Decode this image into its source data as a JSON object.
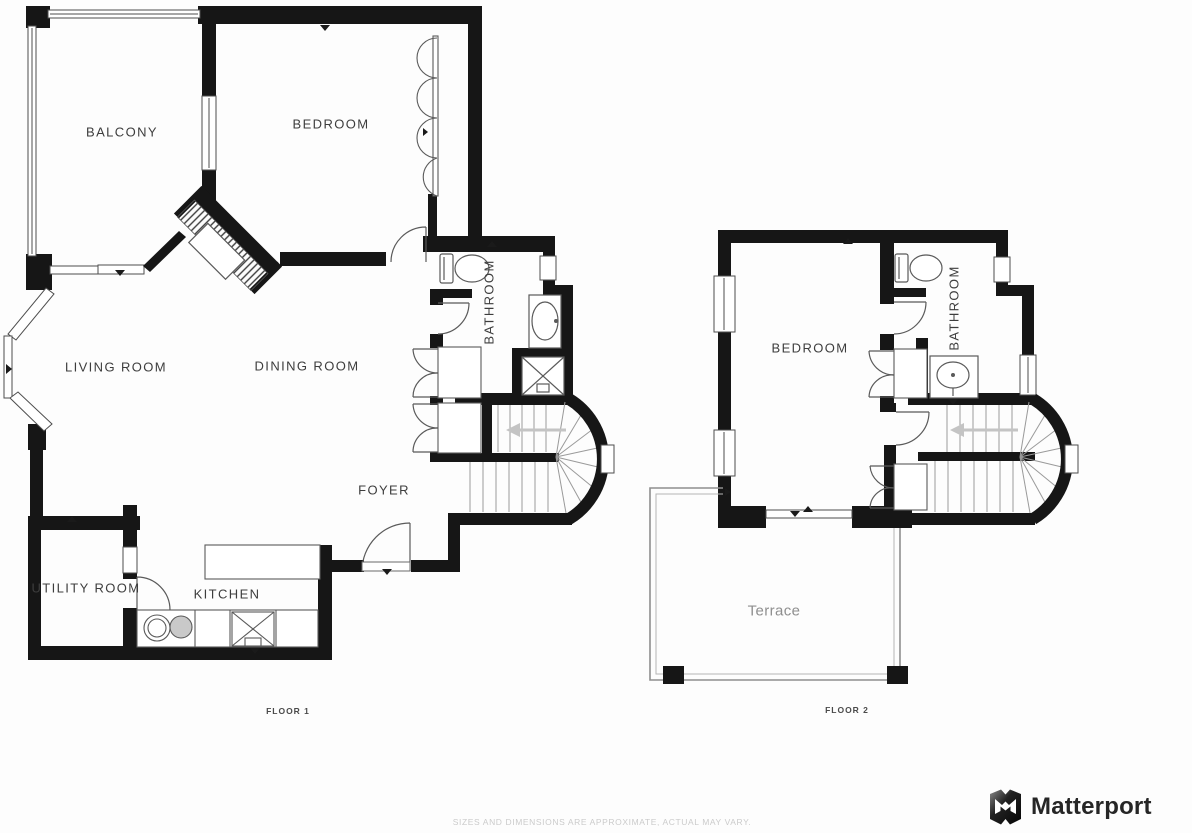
{
  "floor1": {
    "label": "FLOOR 1",
    "rooms": {
      "balcony": "BALCONY",
      "bedroom": "BEDROOM",
      "living_room": "LIVING ROOM",
      "dining_room": "DINING ROOM",
      "bathroom": "BATHROOM",
      "foyer": "FOYER",
      "utility_room": "UTILITY ROOM",
      "kitchen": "KITCHEN"
    }
  },
  "floor2": {
    "label": "FLOOR 2",
    "rooms": {
      "bedroom": "BEDROOM",
      "bathroom": "BATHROOM",
      "terrace": "Terrace"
    }
  },
  "footer": {
    "disclaimer": "SIZES AND DIMENSIONS ARE APPROXIMATE, ACTUAL MAY VARY.",
    "brand": "Matterport"
  },
  "colors": {
    "wall": "#161616",
    "thin_line": "#4d4d4d",
    "tread_line": "#9a9a9a",
    "stair_arrow": "#c4c4c4",
    "room_label": "#3d3d3d",
    "terrace_label": "#8f8f8f",
    "floor_label": "#4a4a4a",
    "disclaimer": "#cbcbcb",
    "brand_text": "#262626"
  },
  "icons": {
    "brand_logo": "matterport-m-icon",
    "stair_direction": "left-arrow"
  }
}
